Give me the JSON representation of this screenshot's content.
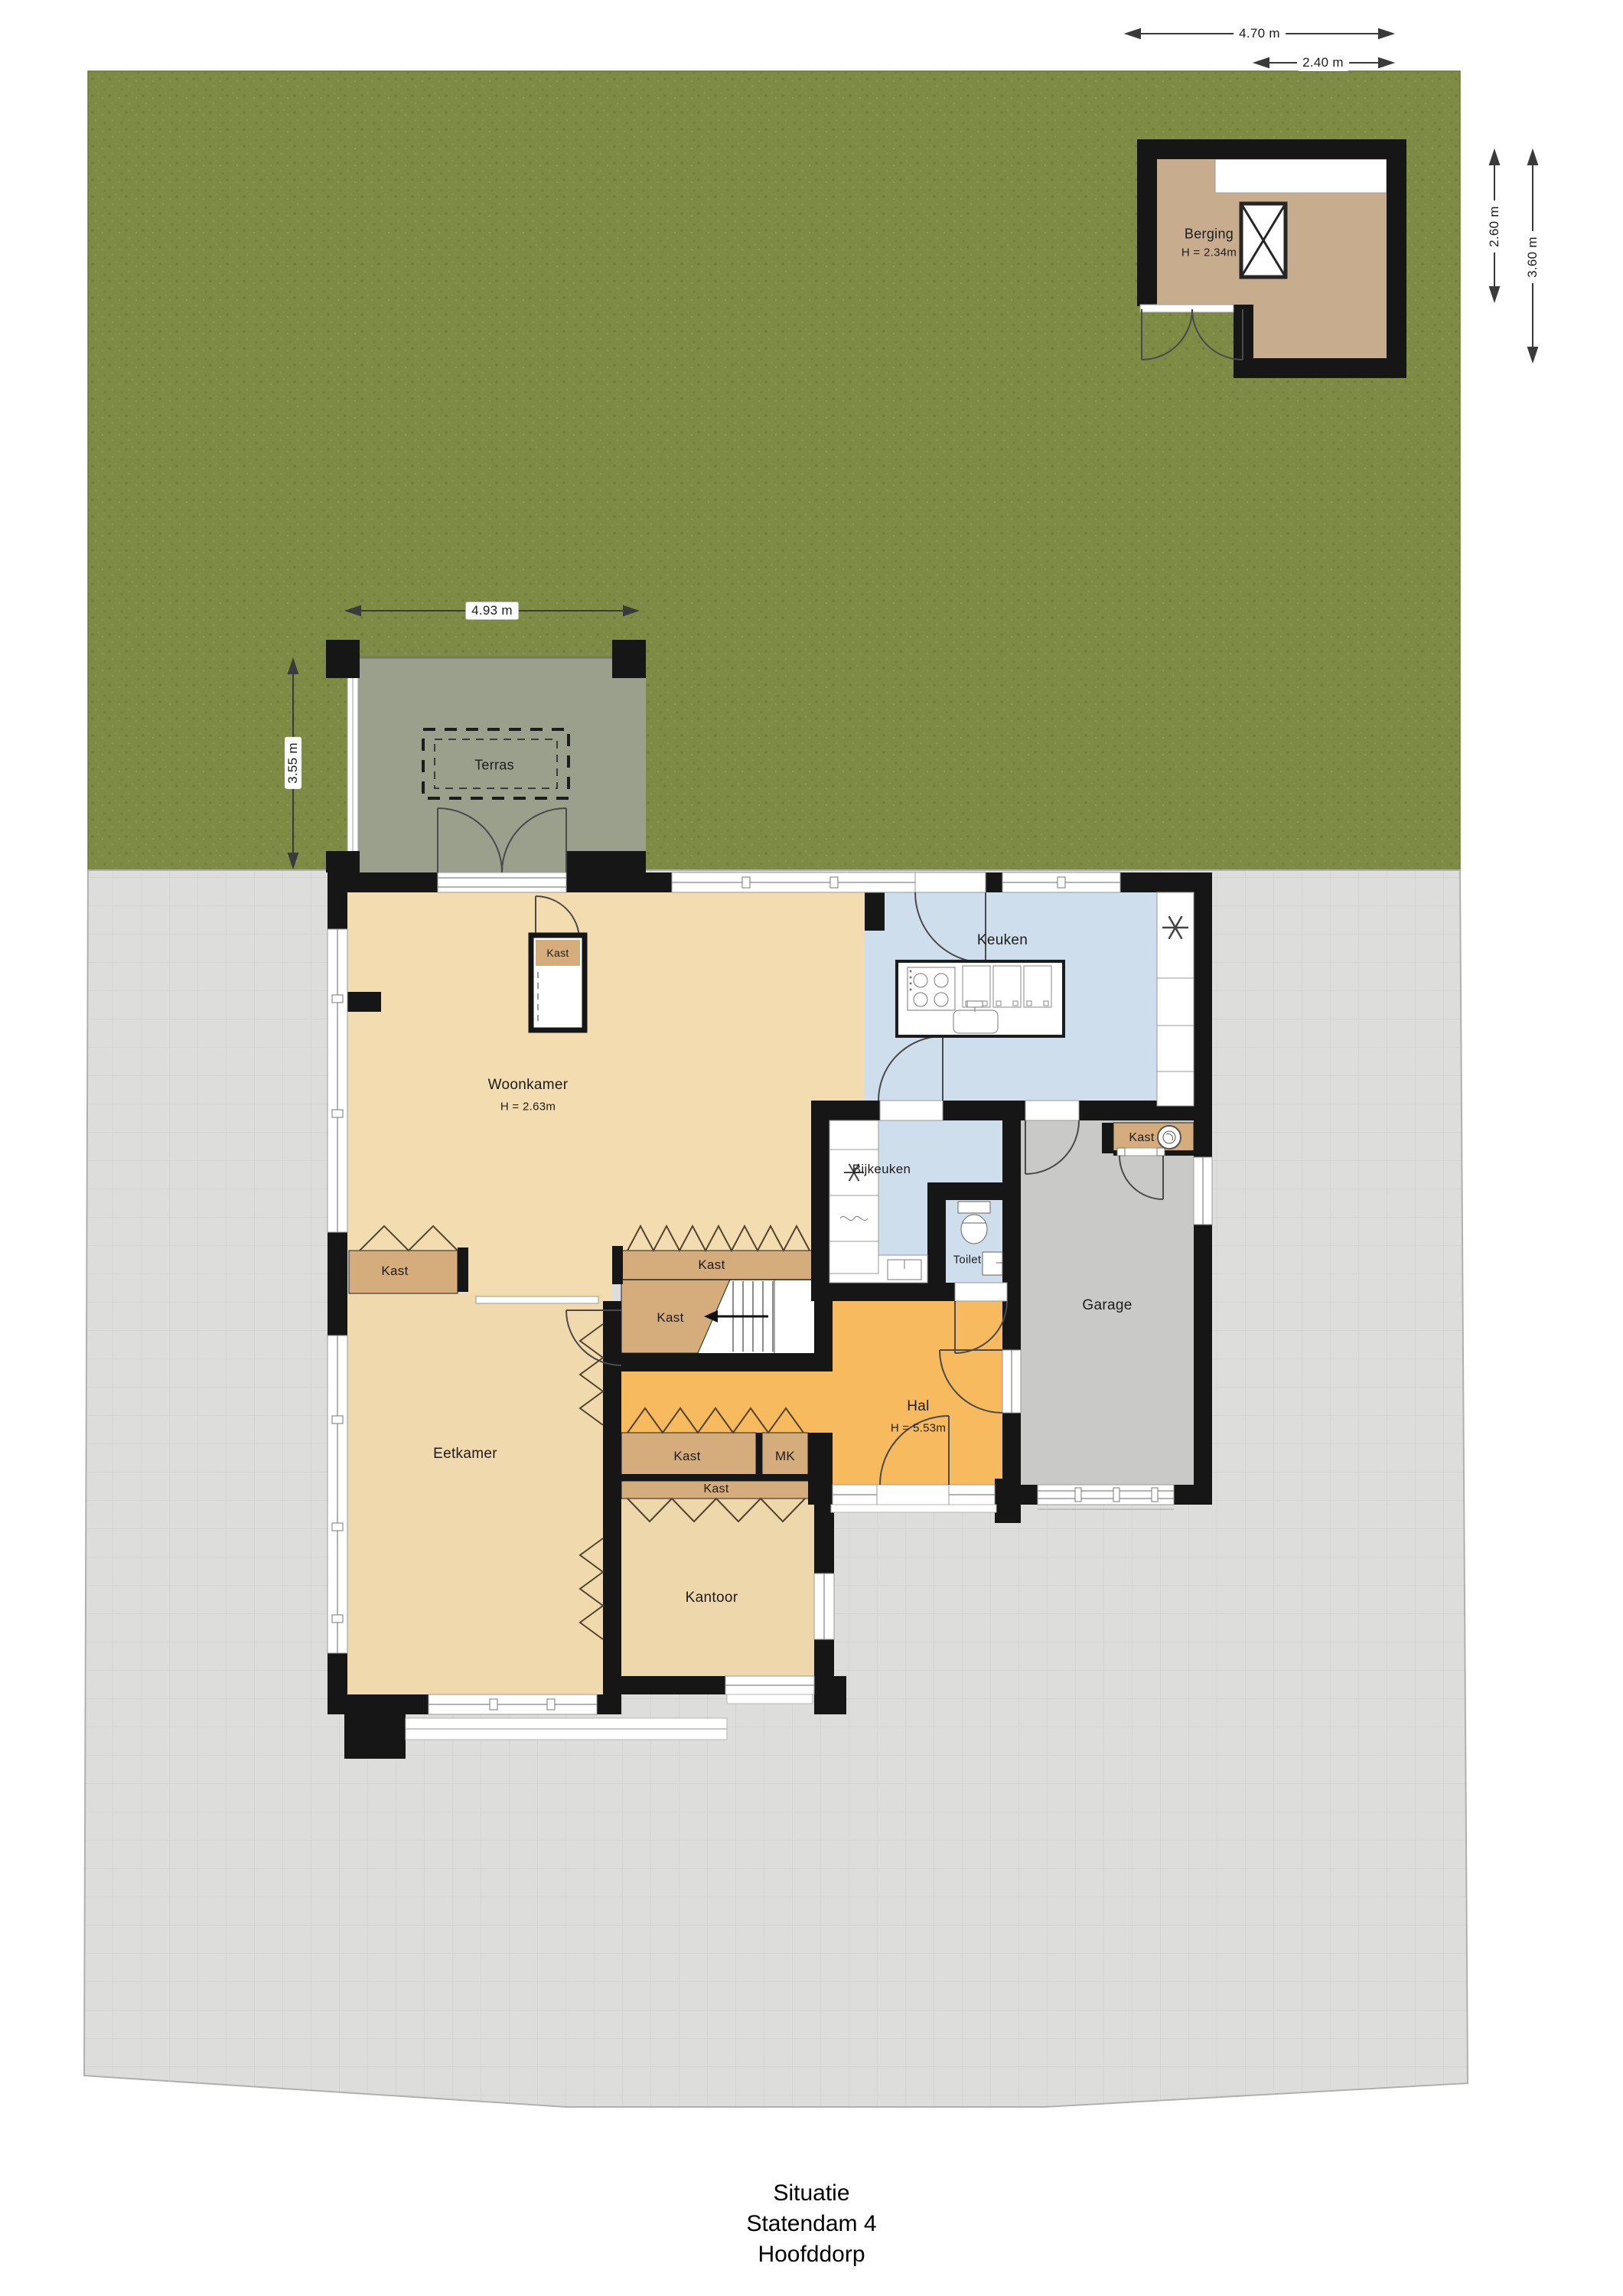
{
  "footer": {
    "line1": "Situatie",
    "line2": "Statendam 4",
    "line3": "Hoofddorp"
  },
  "rooms": {
    "woonkamer": {
      "name": "Woonkamer",
      "height": "H = 2.63m"
    },
    "keuken": {
      "name": "Keuken"
    },
    "bijkeuken": {
      "name": "Bijkeuken"
    },
    "toilet": {
      "name": "Toilet"
    },
    "garage": {
      "name": "Garage"
    },
    "hal": {
      "name": "Hal",
      "height": "H = 5.53m"
    },
    "eetkamer": {
      "name": "Eetkamer"
    },
    "kantoor": {
      "name": "Kantoor"
    },
    "berging": {
      "name": "Berging",
      "height": "H = 2.34m"
    },
    "terras": {
      "name": "Terras"
    }
  },
  "closets": {
    "kast": "Kast",
    "mk": "MK"
  },
  "dimensions": {
    "shed_width_outer": "4.70 m",
    "shed_width_inner": "2.40 m",
    "shed_depth_inner": "2.60 m",
    "shed_depth_outer": "3.60 m",
    "terrace_width": "4.93 m",
    "terrace_depth": "3.55 m"
  },
  "colors": {
    "garden": "#7d8b45",
    "paving": "#dddddb",
    "terrace": "#9ba08d",
    "living": "#f2dcb0",
    "hall": "#f7ba5e",
    "kitchen": "#cfdeec",
    "garage": "#c9c9c7",
    "closet": "#d5ad7c",
    "shed": "#c7ad8d",
    "wall": "#161616"
  }
}
